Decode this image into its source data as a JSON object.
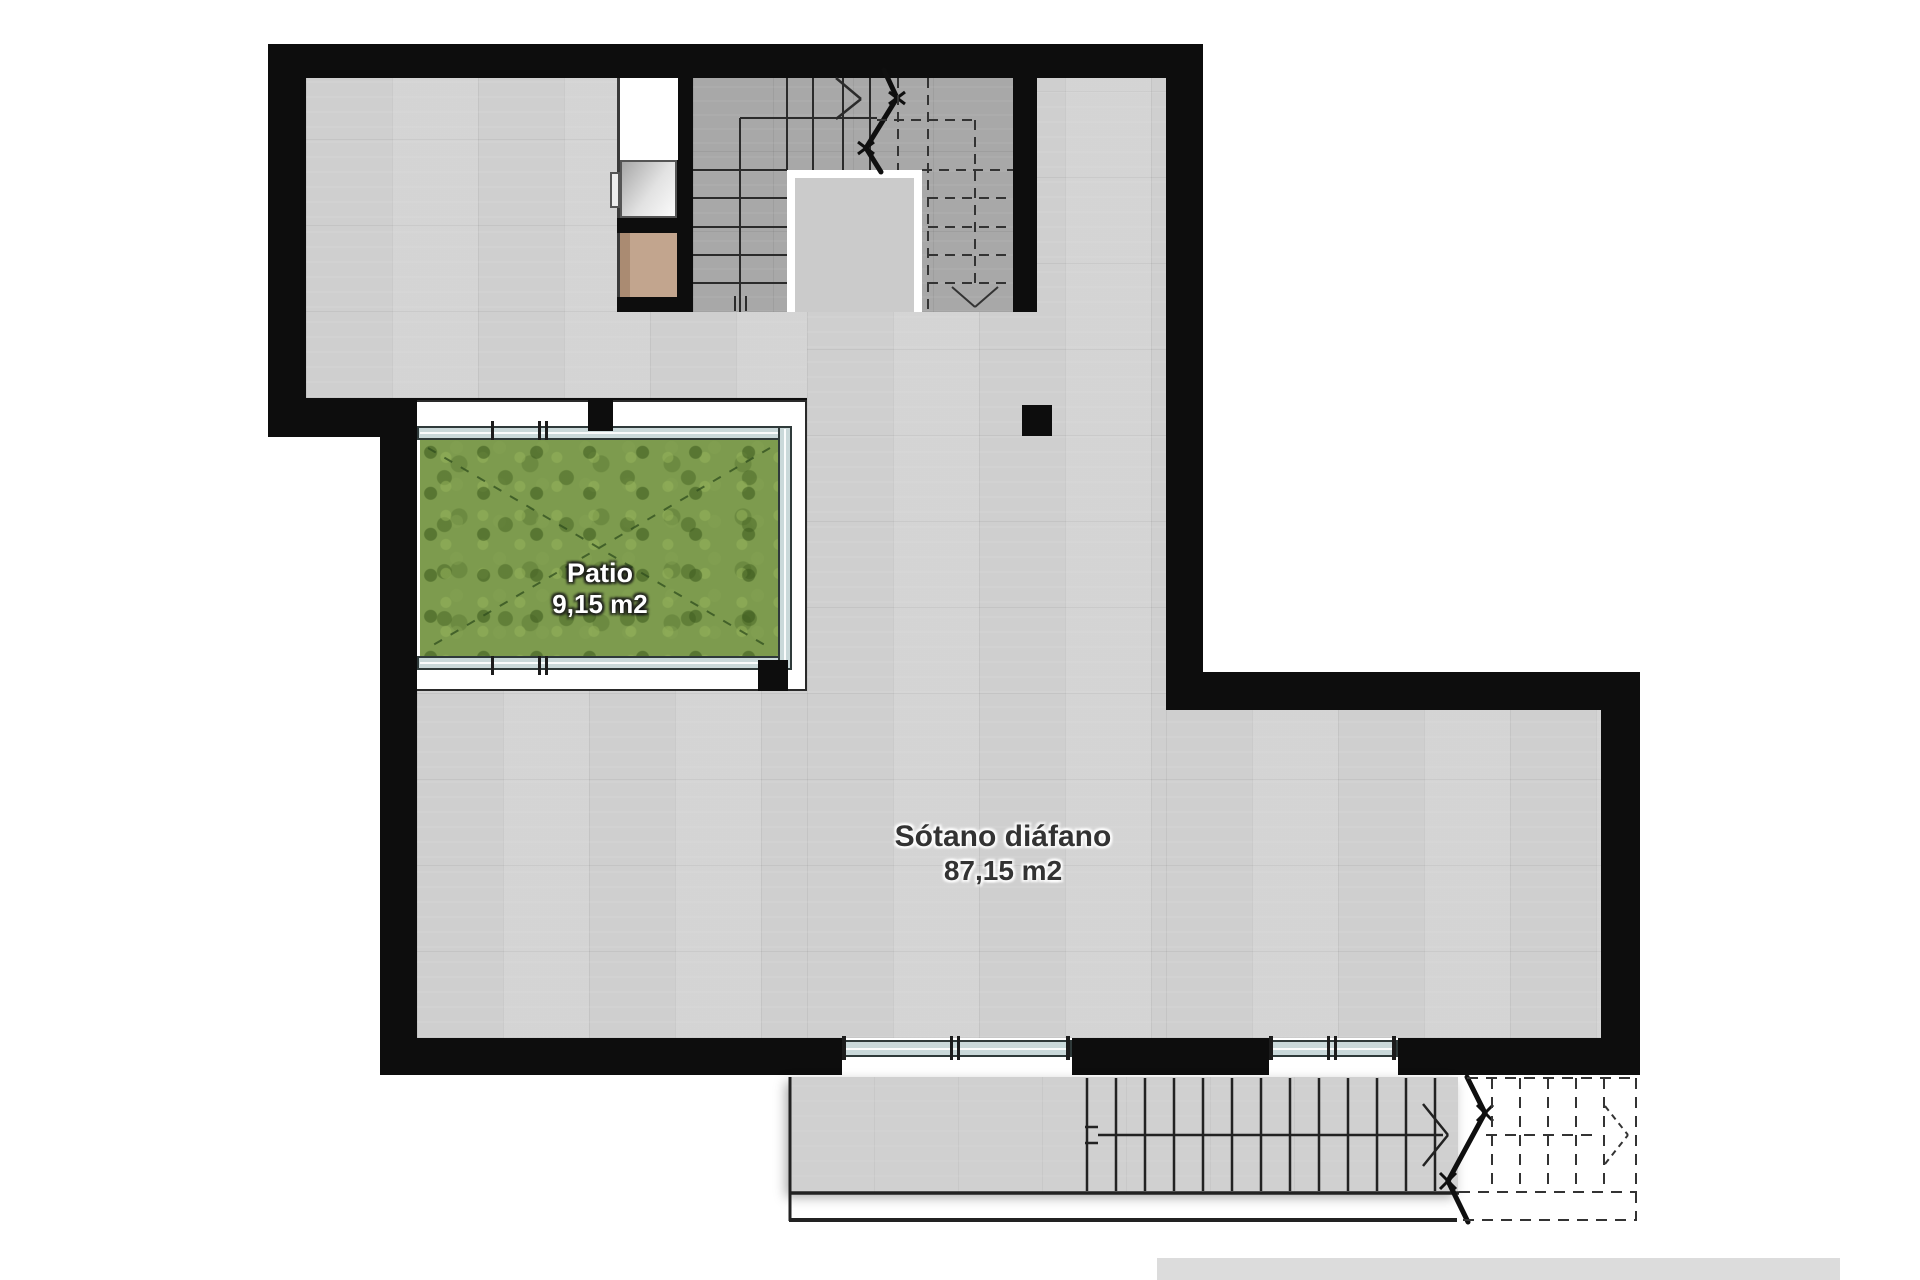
{
  "labels": {
    "patio": {
      "name": "Patio",
      "area": "9,15 m2"
    },
    "sotano": {
      "name": "Sótano diáfano",
      "area": "87,15 m2"
    }
  },
  "colors": {
    "wall": "#0d0d0d",
    "floor": "#d3d3d3",
    "stair_floor": "#a8a8a8",
    "stair_void": "#cbcbcb",
    "grass": "#7d9b4e",
    "glazing": "#cad9da",
    "cabinet_tan": "#c2a58e",
    "terrace": "#d0d0d0",
    "bottom_bar": "#dcdcdc",
    "background": "#ffffff"
  }
}
